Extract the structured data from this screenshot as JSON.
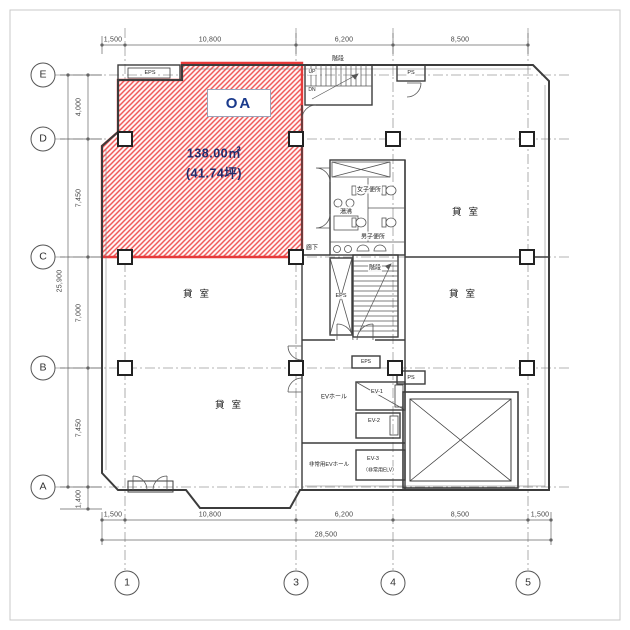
{
  "oa_area": {
    "label": "OA",
    "area_m2": "138.00㎡",
    "area_tsubo": "(41.74坪)"
  },
  "grid": {
    "rows": [
      "E",
      "D",
      "C",
      "B",
      "A"
    ],
    "cols": [
      "1",
      "3",
      "4",
      "5"
    ]
  },
  "dimensions": {
    "top": [
      "1,500",
      "10,800",
      "6,200",
      "8,500"
    ],
    "bottom": [
      "1,500",
      "10,800",
      "6,200",
      "8,500",
      "1,500"
    ],
    "bottom_total": "28,500",
    "left": [
      "4,000",
      "7,450",
      "7,000",
      "7,450"
    ],
    "left_total": "25,900",
    "left_bottom": "1,400"
  },
  "rooms": {
    "tenant": "貸室"
  },
  "core": {
    "stair_top": "階段",
    "stair_mid": "階段",
    "up": "UP",
    "dn": "DN",
    "ps_top": "PS",
    "ps_mid": "PS",
    "eps_topleft": "EPS",
    "eps_stair": "EPS",
    "eps_ev": "EPS",
    "corridor": "廊下",
    "women_toilet": "女子便所",
    "men_toilet": "男子便所",
    "hot_water": "湯沸",
    "ev_hall": "EVホール",
    "ev1": "EV-1",
    "ev2": "EV-2",
    "ev3": "EV-3",
    "ev3_note": "（非常用ELV）",
    "emergency_ev_hall": "非常用EVホール"
  },
  "colors": {
    "hatch_line": "#f05a5a",
    "hatch_bg": "#fff4f4",
    "oa_border": "#e63b3b",
    "oa_text": "#1a3a8c",
    "area_text": "#202c6d",
    "wall": "#3c3c3c",
    "grid_line": "#999999"
  }
}
